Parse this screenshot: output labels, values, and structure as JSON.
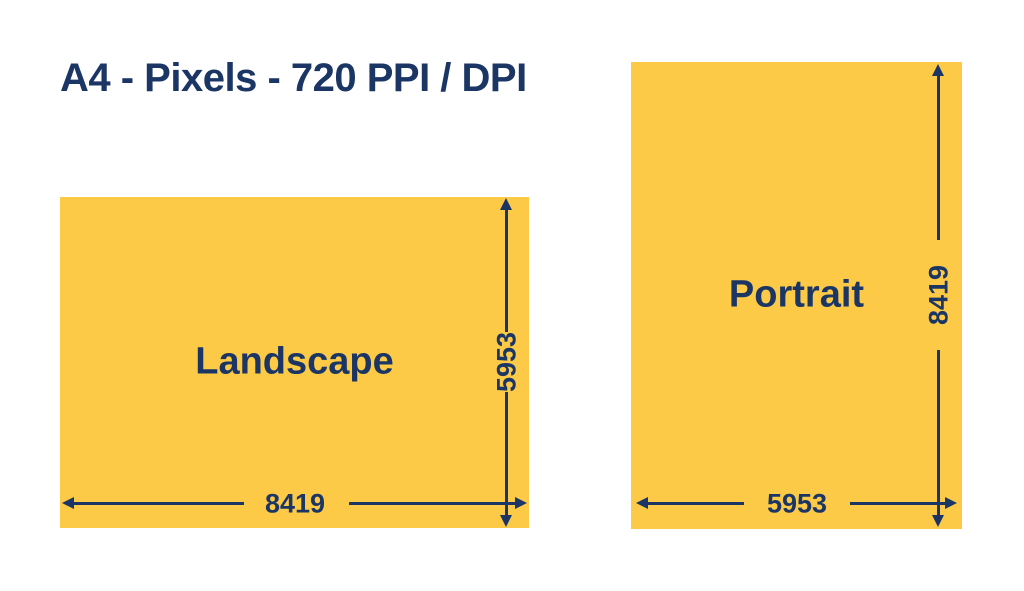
{
  "title": "A4 - Pixels - 720 PPI / DPI",
  "colors": {
    "paper_yellow": "#FCCA47",
    "ink_navy": "#1B3665",
    "background": "#FFFFFF"
  },
  "landscape": {
    "label": "Landscape",
    "width_value": "8419",
    "height_value": "5953"
  },
  "portrait": {
    "label": "Portrait",
    "width_value": "5953",
    "height_value": "8419"
  }
}
